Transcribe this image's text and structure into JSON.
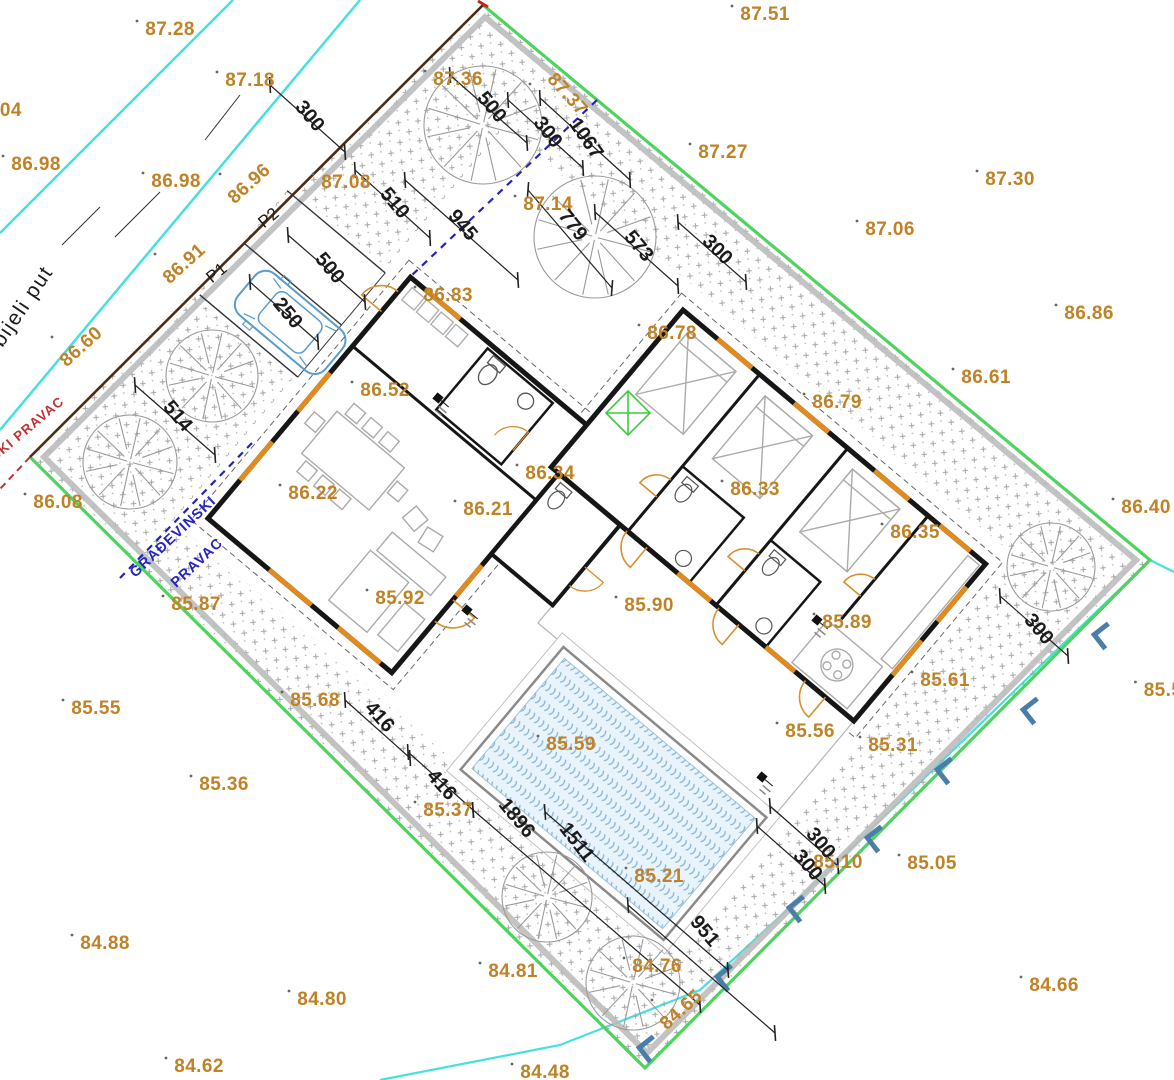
{
  "colors": {
    "elevation": "#bf8226",
    "dimension": "#1b1b1b",
    "boundary_green": "#4ed45e",
    "boundary_gray_band": "#bcbcbc",
    "boundary_road_edge": "#4a2c12",
    "road_line_cyan": "#45e0e0",
    "building_line_blue": "#2323bb",
    "regulation_red": "#c23232",
    "wall_black": "#161616",
    "window_orange": "#e08a20",
    "door_orange": "#d98f2e",
    "furniture_gray": "#ababab",
    "tree_gray": "#9a9a9a",
    "pool_water": "#e9f3fb",
    "pool_wave": "#85b5d6",
    "bracket_blue": "#4a7ea9",
    "car_blue": "#5a9bd0",
    "diamond_green": "#3ecb3e",
    "hatch_gray": "#a5a5aa"
  },
  "labels": {
    "road_name": "bijeli put",
    "building_line_1": "GRAĐEVINSKI",
    "building_line_2": "PRAVAC",
    "regulation_line": "SKI PRAVAC",
    "parking_1": "P1",
    "parking_2": "P2"
  },
  "elevations": [
    {
      "v": "87.28",
      "x": 170,
      "y": 29
    },
    {
      "v": "87.51",
      "x": 765,
      "y": 14
    },
    {
      "v": "87.18",
      "x": 250,
      "y": 80
    },
    {
      "v": "87.36",
      "x": 458,
      "y": 79
    },
    {
      "v": "87.37",
      "x": 563,
      "y": 92,
      "rot": 48
    },
    {
      "v": "87.27",
      "x": 723,
      "y": 152
    },
    {
      "v": "87.30",
      "x": 1010,
      "y": 179
    },
    {
      "v": ".04",
      "x": 8,
      "y": 110
    },
    {
      "v": "86.98",
      "x": 36,
      "y": 164
    },
    {
      "v": "86.98",
      "x": 176,
      "y": 181
    },
    {
      "v": "86.96",
      "x": 253,
      "y": 182,
      "rot": -42
    },
    {
      "v": "87.08",
      "x": 346,
      "y": 182
    },
    {
      "v": "87.14",
      "x": 548,
      "y": 204
    },
    {
      "v": "87.06",
      "x": 890,
      "y": 229
    },
    {
      "v": "86.91",
      "x": 188,
      "y": 262,
      "rot": -42
    },
    {
      "v": "86.86",
      "x": 1089,
      "y": 313
    },
    {
      "v": "86.83",
      "x": 448,
      "y": 295
    },
    {
      "v": "86.78",
      "x": 672,
      "y": 333
    },
    {
      "v": "86.60",
      "x": 85,
      "y": 345,
      "rot": -42
    },
    {
      "v": "86.61",
      "x": 986,
      "y": 377
    },
    {
      "v": "86.52",
      "x": 385,
      "y": 390
    },
    {
      "v": "86.79",
      "x": 837,
      "y": 402
    },
    {
      "v": "86.34",
      "x": 550,
      "y": 473
    },
    {
      "v": "86.33",
      "x": 755,
      "y": 489
    },
    {
      "v": "86.22",
      "x": 313,
      "y": 493
    },
    {
      "v": "86.08",
      "x": 58,
      "y": 502
    },
    {
      "v": "86.21",
      "x": 488,
      "y": 509
    },
    {
      "v": "86.40",
      "x": 1146,
      "y": 507
    },
    {
      "v": "86.35",
      "x": 915,
      "y": 532
    },
    {
      "v": "85.92",
      "x": 400,
      "y": 598
    },
    {
      "v": "85.87",
      "x": 196,
      "y": 604
    },
    {
      "v": "85.90",
      "x": 649,
      "y": 605
    },
    {
      "v": "85.89",
      "x": 847,
      "y": 622
    },
    {
      "v": "85.61",
      "x": 945,
      "y": 680
    },
    {
      "v": "85.5",
      "x": 1163,
      "y": 690
    },
    {
      "v": "85.55",
      "x": 96,
      "y": 708
    },
    {
      "v": "85.68",
      "x": 315,
      "y": 700
    },
    {
      "v": "85.56",
      "x": 810,
      "y": 731
    },
    {
      "v": "85.31",
      "x": 893,
      "y": 745
    },
    {
      "v": "85.59",
      "x": 571,
      "y": 744
    },
    {
      "v": "85.36",
      "x": 224,
      "y": 784
    },
    {
      "v": "85.37",
      "x": 448,
      "y": 810
    },
    {
      "v": "85.10",
      "x": 838,
      "y": 862
    },
    {
      "v": "85.05",
      "x": 932,
      "y": 863
    },
    {
      "v": "85.21",
      "x": 659,
      "y": 876
    },
    {
      "v": "84.88",
      "x": 105,
      "y": 943
    },
    {
      "v": "84.76",
      "x": 657,
      "y": 966
    },
    {
      "v": "84.81",
      "x": 513,
      "y": 971
    },
    {
      "v": "84.66",
      "x": 1054,
      "y": 985
    },
    {
      "v": "84.80",
      "x": 322,
      "y": 999
    },
    {
      "v": "84.65",
      "x": 685,
      "y": 1008,
      "rot": -42
    },
    {
      "v": "84.62",
      "x": 199,
      "y": 1066
    },
    {
      "v": "84.48",
      "x": 545,
      "y": 1072
    }
  ],
  "dimensions": [
    {
      "v": "300",
      "x": 305,
      "y": 113,
      "rot": 50,
      "line": [
        270,
        85,
        345,
        152
      ]
    },
    {
      "v": "510",
      "x": 390,
      "y": 200,
      "rot": 50,
      "line": [
        355,
        170,
        430,
        238
      ]
    },
    {
      "v": "945",
      "x": 458,
      "y": 222,
      "rot": 50,
      "line": [
        405,
        180,
        518,
        280
      ]
    },
    {
      "v": "500",
      "x": 325,
      "y": 265,
      "rot": 50,
      "line": [
        288,
        235,
        365,
        302
      ]
    },
    {
      "v": "250",
      "x": 283,
      "y": 310,
      "rot": 50,
      "line": [
        250,
        282,
        318,
        342
      ]
    },
    {
      "v": "500",
      "x": 487,
      "y": 104,
      "rot": 50,
      "line": [
        450,
        75,
        527,
        143
      ]
    },
    {
      "v": "300",
      "x": 543,
      "y": 129,
      "rot": 52,
      "line": [
        508,
        100,
        583,
        168
      ]
    },
    {
      "v": "1067",
      "x": 581,
      "y": 135,
      "rot": 55,
      "line": [
        540,
        98,
        630,
        180
      ]
    },
    {
      "v": "779",
      "x": 568,
      "y": 222,
      "rot": 52,
      "line": [
        528,
        190,
        612,
        288
      ]
    },
    {
      "v": "573",
      "x": 634,
      "y": 243,
      "rot": 50,
      "line": [
        595,
        212,
        678,
        286
      ]
    },
    {
      "v": "300",
      "x": 713,
      "y": 247,
      "rot": 45,
      "line": [
        678,
        222,
        746,
        282
      ]
    },
    {
      "v": "514",
      "x": 173,
      "y": 413,
      "rot": 50,
      "line": [
        135,
        385,
        215,
        455
      ]
    },
    {
      "v": "416",
      "x": 375,
      "y": 714,
      "rot": 48,
      "line": [
        345,
        700,
        410,
        758
      ]
    },
    {
      "v": "416",
      "x": 437,
      "y": 782,
      "rot": 48,
      "line": [
        408,
        752,
        473,
        810
      ]
    },
    {
      "v": "1896",
      "x": 512,
      "y": 815,
      "rot": 50,
      "line": [
        473,
        810,
        700,
        1005
      ]
    },
    {
      "v": "1511",
      "x": 572,
      "y": 839,
      "rot": 52,
      "line": [
        545,
        812,
        728,
        970
      ]
    },
    {
      "v": "951",
      "x": 700,
      "y": 928,
      "rot": 50,
      "line": [
        628,
        905,
        775,
        1033
      ]
    },
    {
      "v": "300",
      "x": 816,
      "y": 840,
      "rot": 50,
      "line": [
        770,
        806,
        838,
        866
      ]
    },
    {
      "v": "300",
      "x": 803,
      "y": 862,
      "rot": 50,
      "line": [
        757,
        826,
        825,
        886
      ]
    },
    {
      "v": "300",
      "x": 1034,
      "y": 626,
      "rot": 50,
      "line": [
        1000,
        596,
        1068,
        656
      ]
    }
  ],
  "trees": [
    {
      "x": 483,
      "y": 125,
      "r": 59
    },
    {
      "x": 595,
      "y": 237,
      "r": 61
    },
    {
      "x": 212,
      "y": 376,
      "r": 46
    },
    {
      "x": 130,
      "y": 462,
      "r": 47
    },
    {
      "x": 547,
      "y": 897,
      "r": 45
    },
    {
      "x": 633,
      "y": 983,
      "r": 47
    },
    {
      "x": 1051,
      "y": 567,
      "r": 44
    }
  ],
  "brackets": [
    {
      "x": 1097,
      "y": 635
    },
    {
      "x": 1026,
      "y": 710
    },
    {
      "x": 940,
      "y": 770
    },
    {
      "x": 870,
      "y": 838
    },
    {
      "x": 792,
      "y": 908
    },
    {
      "x": 720,
      "y": 977
    },
    {
      "x": 642,
      "y": 1048
    }
  ],
  "benchmarks": [
    {
      "x": 438,
      "y": 398
    },
    {
      "x": 817,
      "y": 620
    },
    {
      "x": 467,
      "y": 610
    },
    {
      "x": 762,
      "y": 777
    }
  ]
}
